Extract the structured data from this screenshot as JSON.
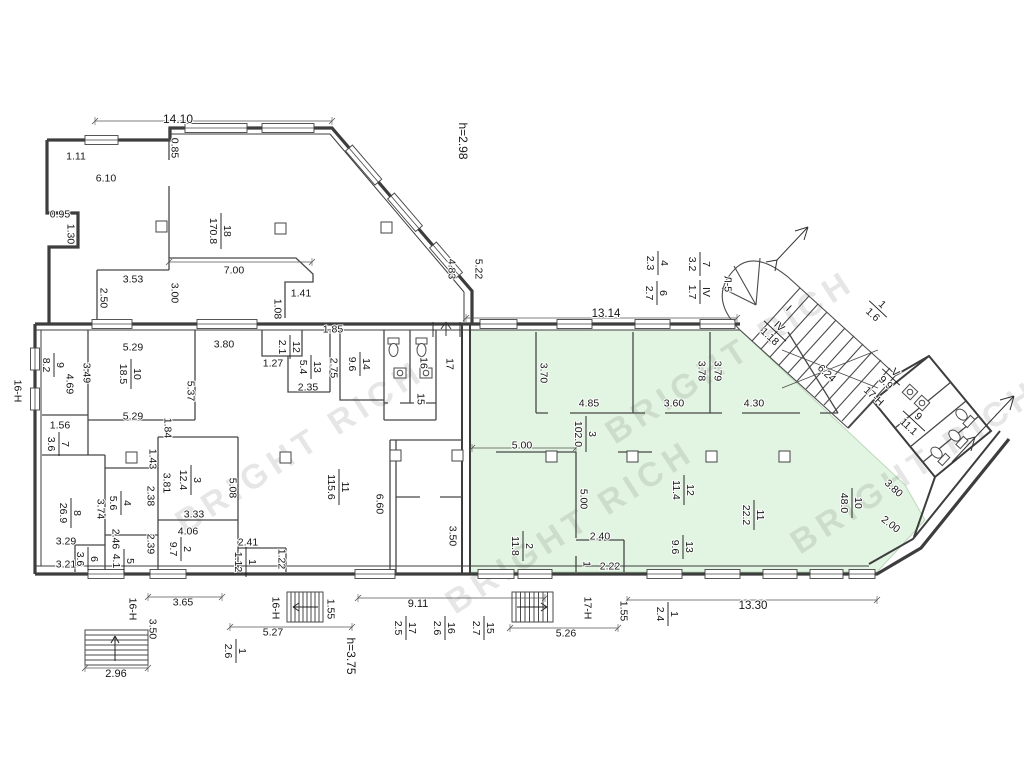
{
  "plan": {
    "green_fill": "#e2f5e2",
    "wall_color": "#3d3d3d",
    "watermark_text": "BRIGHT RICH",
    "heights": {
      "upper_section": "h=2.98",
      "lower_section": "h=3.75"
    }
  },
  "watermarks": [
    {
      "x": 185,
      "y": 535,
      "r": -33
    },
    {
      "x": 455,
      "y": 615,
      "r": -33
    },
    {
      "x": 615,
      "y": 445,
      "r": -33
    },
    {
      "x": 800,
      "y": 555,
      "r": -33
    }
  ],
  "labels": [
    {
      "t": "14.10",
      "x": 178,
      "y": 119,
      "r": 0,
      "s": 12
    },
    {
      "t": "1.11",
      "x": 76,
      "y": 156,
      "r": 0
    },
    {
      "t": "6.10",
      "x": 106,
      "y": 178,
      "r": 0
    },
    {
      "t": "0.95",
      "x": 60,
      "y": 214,
      "r": 0
    },
    {
      "t": "1.30",
      "x": 71,
      "y": 234,
      "r": 90
    },
    {
      "t": "0.85",
      "x": 175,
      "y": 148,
      "r": 90
    },
    {
      "t": "3.53",
      "x": 133,
      "y": 279,
      "r": 0
    },
    {
      "t": "2.50",
      "x": 104,
      "y": 298,
      "r": 90
    },
    {
      "t": "3.00",
      "x": 175,
      "y": 293,
      "r": 90
    },
    {
      "t": "7.00",
      "x": 234,
      "y": 270,
      "r": 0
    },
    {
      "t": "1.41",
      "x": 301,
      "y": 293,
      "r": 0
    },
    {
      "t": "1.08",
      "x": 278,
      "y": 309,
      "r": 90
    },
    {
      "t": "1.85",
      "x": 333,
      "y": 329,
      "r": 0
    },
    {
      "t": "h=2.98",
      "x": 463,
      "y": 141,
      "r": 90,
      "s": 12
    },
    {
      "t": "4.83",
      "x": 452,
      "y": 269,
      "r": 90
    },
    {
      "t": "5.22",
      "x": 479,
      "y": 269,
      "r": 90
    },
    {
      "t": "13.14",
      "x": 606,
      "y": 313,
      "r": 0,
      "s": 11.5
    },
    {
      "t": "Л-5",
      "x": 728,
      "y": 284,
      "r": 90
    },
    {
      "t": "I",
      "x": 789,
      "y": 308,
      "r": 43
    },
    {
      "t": "6.24",
      "x": 827,
      "y": 373,
      "r": 43
    },
    {
      "t": "5.29",
      "x": 133,
      "y": 347,
      "r": 0
    },
    {
      "t": "3.80",
      "x": 224,
      "y": 344,
      "r": 0
    },
    {
      "t": "3.49",
      "x": 87,
      "y": 373,
      "r": 90
    },
    {
      "t": "4.69",
      "x": 70,
      "y": 384,
      "r": 90
    },
    {
      "t": "5.37",
      "x": 191,
      "y": 391,
      "r": 90
    },
    {
      "t": "5.29",
      "x": 133,
      "y": 416,
      "r": 0
    },
    {
      "t": "1.56",
      "x": 60,
      "y": 425,
      "r": 0
    },
    {
      "t": "1.84",
      "x": 168,
      "y": 428,
      "r": 90
    },
    {
      "t": "1.27",
      "x": 273,
      "y": 363,
      "r": 0
    },
    {
      "t": "2.75",
      "x": 334,
      "y": 368,
      "r": 90
    },
    {
      "t": "2.35",
      "x": 308,
      "y": 387,
      "r": 0
    },
    {
      "t": "16",
      "x": 424,
      "y": 363,
      "r": 90
    },
    {
      "t": "17",
      "x": 450,
      "y": 364,
      "r": 90
    },
    {
      "t": "15",
      "x": 421,
      "y": 399,
      "r": 90
    },
    {
      "t": "16-Н",
      "x": 18,
      "y": 391,
      "r": 90
    },
    {
      "t": "1.43",
      "x": 153,
      "y": 459,
      "r": 90
    },
    {
      "t": "3.81",
      "x": 167,
      "y": 483,
      "r": 90
    },
    {
      "t": "5.08",
      "x": 233,
      "y": 488,
      "r": 90
    },
    {
      "t": "2.38",
      "x": 151,
      "y": 496,
      "r": 90
    },
    {
      "t": "3.74",
      "x": 101,
      "y": 509,
      "r": 90
    },
    {
      "t": "3.33",
      "x": 194,
      "y": 514,
      "r": 0
    },
    {
      "t": "4.06",
      "x": 188,
      "y": 531,
      "r": 0
    },
    {
      "t": "3.29",
      "x": 66,
      "y": 541,
      "r": 0
    },
    {
      "t": "2.46",
      "x": 116,
      "y": 539,
      "r": 90
    },
    {
      "t": "2.39",
      "x": 151,
      "y": 544,
      "r": 90
    },
    {
      "t": "2.41",
      "x": 248,
      "y": 542,
      "r": 0
    },
    {
      "t": "3.21",
      "x": 66,
      "y": 564,
      "r": 0
    },
    {
      "t": "1.22",
      "x": 282,
      "y": 559,
      "r": 90
    },
    {
      "t": "6.60",
      "x": 380,
      "y": 504,
      "r": 90
    },
    {
      "t": "3.50",
      "x": 453,
      "y": 536,
      "r": 90
    },
    {
      "t": "3.70",
      "x": 544,
      "y": 373,
      "r": 90
    },
    {
      "t": "4.85",
      "x": 589,
      "y": 403,
      "r": 0
    },
    {
      "t": "3.78",
      "x": 702,
      "y": 371,
      "r": 90
    },
    {
      "t": "3.60",
      "x": 674,
      "y": 403,
      "r": 0
    },
    {
      "t": "3.79",
      "x": 718,
      "y": 371,
      "r": 90
    },
    {
      "t": "4.30",
      "x": 754,
      "y": 403,
      "r": 0
    },
    {
      "t": "5.00",
      "x": 522,
      "y": 445,
      "r": 0
    },
    {
      "t": "5.00",
      "x": 584,
      "y": 499,
      "r": 90
    },
    {
      "t": "2.40",
      "x": 600,
      "y": 536,
      "r": 0
    },
    {
      "t": "1",
      "x": 587,
      "y": 564,
      "r": 90
    },
    {
      "t": "2.22",
      "x": 610,
      "y": 566,
      "r": 0
    },
    {
      "t": "3.80",
      "x": 894,
      "y": 488,
      "r": 43
    },
    {
      "t": "2.00",
      "x": 891,
      "y": 524,
      "r": 38
    },
    {
      "t": "17-Н",
      "x": 874,
      "y": 396,
      "r": 43
    },
    {
      "t": "16-Н",
      "x": 133,
      "y": 609,
      "r": 90
    },
    {
      "t": "3.65",
      "x": 183,
      "y": 602,
      "r": 0
    },
    {
      "t": "3.50",
      "x": 153,
      "y": 629,
      "r": 90
    },
    {
      "t": "2.96",
      "x": 116,
      "y": 673,
      "r": 0,
      "s": 11
    },
    {
      "t": "16-Н",
      "x": 276,
      "y": 608,
      "r": 90
    },
    {
      "t": "5.27",
      "x": 273,
      "y": 632,
      "r": 0
    },
    {
      "t": "1.55",
      "x": 331,
      "y": 609,
      "r": 90
    },
    {
      "t": "h=3.75",
      "x": 351,
      "y": 656,
      "r": 90,
      "s": 12
    },
    {
      "t": "9.11",
      "x": 418,
      "y": 603,
      "r": 0,
      "s": 11
    },
    {
      "t": "17-Н",
      "x": 588,
      "y": 608,
      "r": 90
    },
    {
      "t": "5.26",
      "x": 566,
      "y": 633,
      "r": 0
    },
    {
      "t": "1.55",
      "x": 624,
      "y": 611,
      "r": 90
    },
    {
      "t": "13.30",
      "x": 753,
      "y": 605,
      "r": 0,
      "s": 11.5
    }
  ],
  "fractions": [
    {
      "n": "18",
      "d": "170.8",
      "x": 221,
      "y": 231,
      "r": 90
    },
    {
      "n": "9",
      "d": "8.2",
      "x": 54,
      "y": 365,
      "r": 90
    },
    {
      "n": "10",
      "d": "18.5",
      "x": 131,
      "y": 374,
      "r": 90
    },
    {
      "n": "12",
      "d": "2.1",
      "x": 290,
      "y": 347,
      "r": 90
    },
    {
      "n": "13",
      "d": "5.4",
      "x": 311,
      "y": 367,
      "r": 90
    },
    {
      "n": "14",
      "d": "9.6",
      "x": 360,
      "y": 364,
      "r": 90
    },
    {
      "n": "7",
      "d": "3.6",
      "x": 59,
      "y": 444,
      "r": 90
    },
    {
      "n": "3",
      "d": "12.4",
      "x": 191,
      "y": 480,
      "r": 90
    },
    {
      "n": "4",
      "d": "5.6",
      "x": 121,
      "y": 503,
      "r": 90
    },
    {
      "n": "8",
      "d": "26.9",
      "x": 71,
      "y": 513,
      "r": 90
    },
    {
      "n": "2",
      "d": "9.7",
      "x": 181,
      "y": 549,
      "r": 90
    },
    {
      "n": "5",
      "d": "4.1",
      "x": 124,
      "y": 561,
      "r": 90
    },
    {
      "n": "6",
      "d": "3.6",
      "x": 88,
      "y": 559,
      "r": 90
    },
    {
      "n": "1",
      "d": "1.12",
      "x": 246,
      "y": 562,
      "r": 90
    },
    {
      "n": "11",
      "d": "115.6",
      "x": 339,
      "y": 487,
      "r": 90
    },
    {
      "n": "3",
      "d": "102.0",
      "x": 586,
      "y": 434,
      "r": 90
    },
    {
      "n": "2",
      "d": "11.8",
      "x": 523,
      "y": 546,
      "r": 90
    },
    {
      "n": "12",
      "d": "11.4",
      "x": 684,
      "y": 490,
      "r": 90
    },
    {
      "n": "13",
      "d": "9.6",
      "x": 683,
      "y": 547,
      "r": 90
    },
    {
      "n": "11",
      "d": "22.2",
      "x": 754,
      "y": 515,
      "r": 90
    },
    {
      "n": "10",
      "d": "48.0",
      "x": 852,
      "y": 503,
      "r": 90
    },
    {
      "n": "7",
      "d": "3.2",
      "x": 700,
      "y": 264,
      "r": 90
    },
    {
      "n": "4",
      "d": "2.3",
      "x": 658,
      "y": 263,
      "r": 90
    },
    {
      "n": "IV",
      "d": "1.7",
      "x": 700,
      "y": 292,
      "r": 90
    },
    {
      "n": "6",
      "d": "2.7",
      "x": 657,
      "y": 293,
      "r": 90
    },
    {
      "n": "1",
      "d": "1.6",
      "x": 878,
      "y": 309,
      "r": 43
    },
    {
      "n": "IV",
      "d": "1.18",
      "x": 775,
      "y": 331,
      "r": 43
    },
    {
      "n": "V",
      "d": "9.9",
      "x": 891,
      "y": 377,
      "r": 43
    },
    {
      "n": "9",
      "d": "11.1",
      "x": 914,
      "y": 421,
      "r": 43
    },
    {
      "n": "17",
      "d": "2.5",
      "x": 406,
      "y": 628,
      "r": 90
    },
    {
      "n": "16",
      "d": "2.6",
      "x": 445,
      "y": 628,
      "r": 90
    },
    {
      "n": "15",
      "d": "2.7",
      "x": 484,
      "y": 628,
      "r": 90
    },
    {
      "n": "1",
      "d": "2.6",
      "x": 236,
      "y": 651,
      "r": 90
    },
    {
      "n": "1",
      "d": "2.4",
      "x": 668,
      "y": 614,
      "r": 90
    }
  ]
}
